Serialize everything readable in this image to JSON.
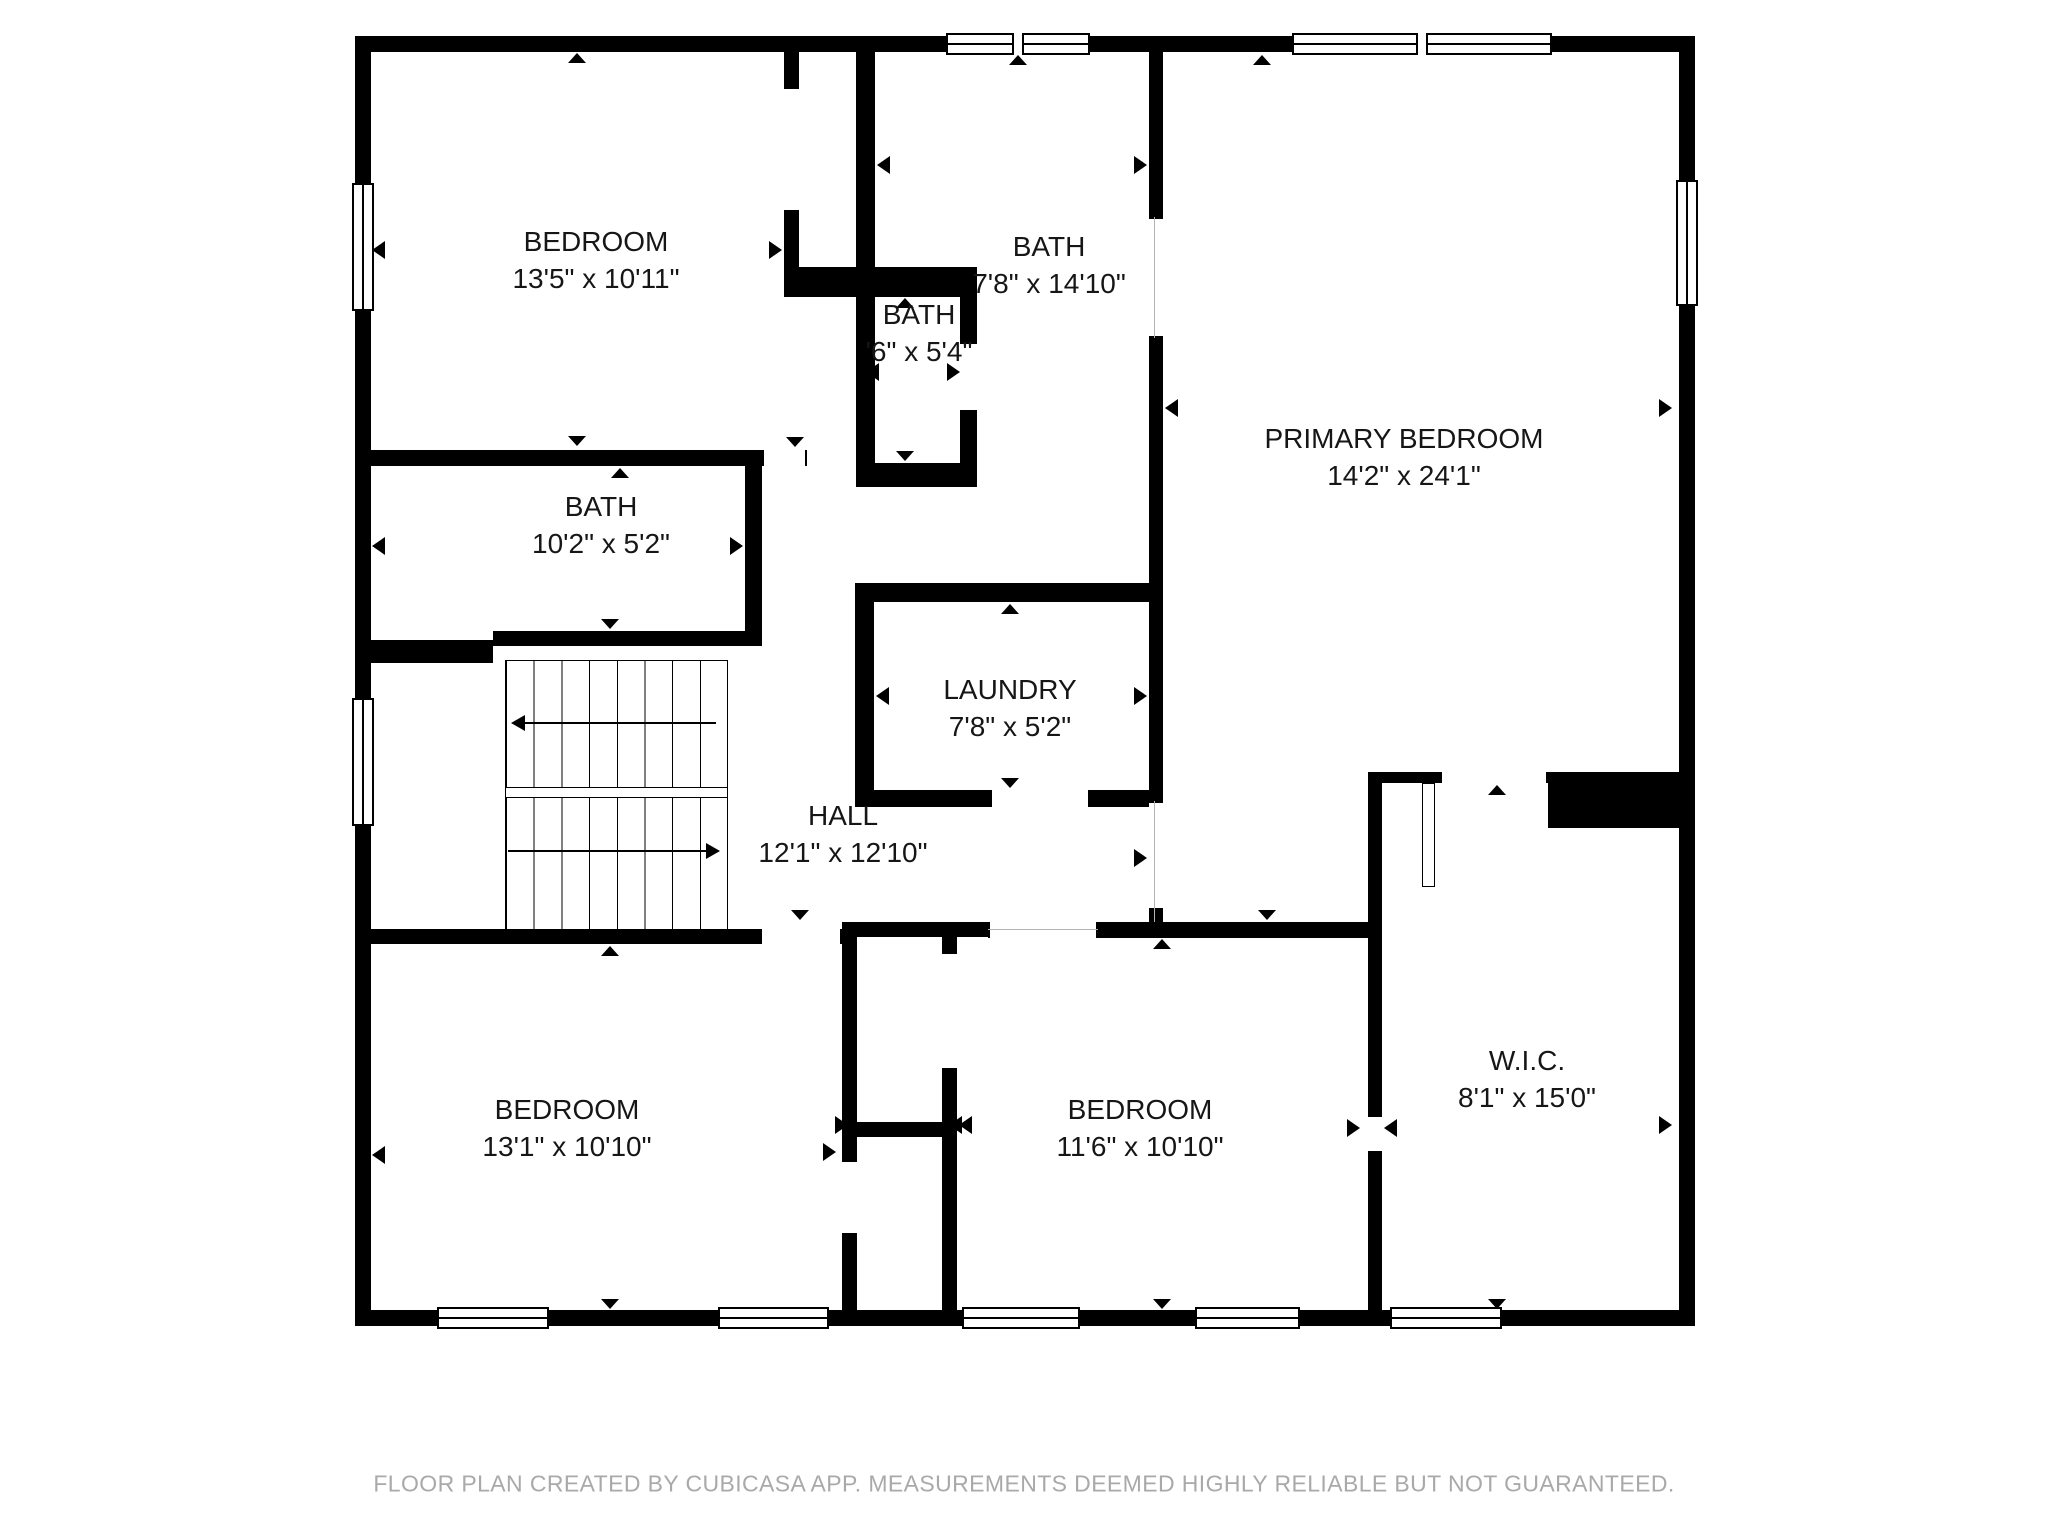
{
  "rooms": [
    {
      "id": "bedroom-top-left",
      "name": "BEDROOM",
      "dims": "13'5\" x 10'11\""
    },
    {
      "id": "bath-main",
      "name": "BATH",
      "dims": "7'8\" x 14'10\""
    },
    {
      "id": "bath-small",
      "name": "BATH",
      "dims": "'6\" x 5'4\""
    },
    {
      "id": "bath-left",
      "name": "BATH",
      "dims": "10'2\" x 5'2\""
    },
    {
      "id": "laundry",
      "name": "LAUNDRY",
      "dims": "7'8\" x 5'2\""
    },
    {
      "id": "hall",
      "name": "HALL",
      "dims": "12'1\" x 12'10\""
    },
    {
      "id": "primary-bedroom",
      "name": "PRIMARY BEDROOM",
      "dims": "14'2\" x 24'1\""
    },
    {
      "id": "bedroom-bottom-left",
      "name": "BEDROOM",
      "dims": "13'1\" x 10'10\""
    },
    {
      "id": "bedroom-bottom-middle",
      "name": "BEDROOM",
      "dims": "11'6\" x 10'10\""
    },
    {
      "id": "wic",
      "name": "W.I.C.",
      "dims": "8'1\" x 15'0\""
    }
  ],
  "footer": {
    "disclaimer": "FLOOR PLAN CREATED BY CUBICASA APP. MEASUREMENTS DEEMED HIGHLY RELIABLE BUT NOT GUARANTEED."
  },
  "colors": {
    "wall": "#000000",
    "background": "#ffffff",
    "label_text": "#161616",
    "footer_text": "#a9a9a9"
  }
}
